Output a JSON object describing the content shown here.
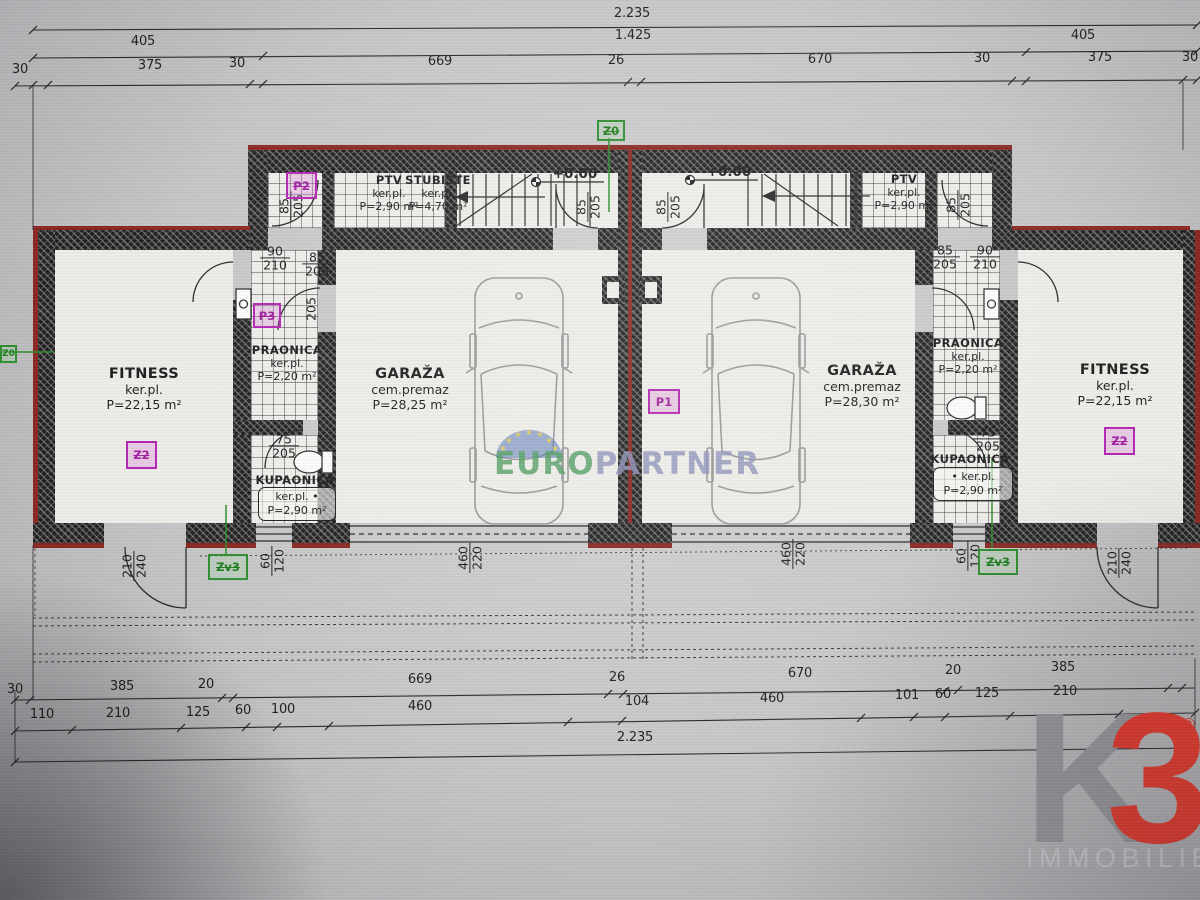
{
  "plan": {
    "dims_top": {
      "row1": [
        "2.235"
      ],
      "row2": [
        "405",
        "1.425",
        "405"
      ],
      "row3": [
        "30",
        "375",
        "30",
        "669",
        "26",
        "670",
        "30",
        "375",
        "30"
      ]
    },
    "dims_bottom": {
      "row1": [
        "30",
        "385",
        "20",
        "669",
        "26",
        "670",
        "20",
        "385"
      ],
      "row2": [
        "110",
        "210",
        "125",
        "60",
        "100",
        "460",
        "104",
        "460",
        "101",
        "60",
        "125",
        "210"
      ],
      "row3": [
        "2.235"
      ]
    },
    "levels": {
      "left": "+0.00",
      "right": "+0.00"
    },
    "rooms": {
      "fitness_left": {
        "name": "FITNESS",
        "finish": "ker.pl.",
        "area": "P=22,15 m²"
      },
      "fitness_right": {
        "name": "FITNESS",
        "finish": "ker.pl.",
        "area": "P=22,15 m²"
      },
      "garage_left": {
        "name": "GARAŽA",
        "finish": "cem.premaz",
        "area": "P=28,25 m²"
      },
      "garage_right": {
        "name": "GARAŽA",
        "finish": "cem.premaz",
        "area": "P=28,30 m²"
      },
      "ptv_left": {
        "name": "PTV",
        "finish": "ker.pl.",
        "area": "P=2,90 m²"
      },
      "ptv_right": {
        "name": "PTV",
        "finish": "ker.pl.",
        "area": "P=2,90 m²"
      },
      "stubiste": {
        "name": "STUBIŠTE",
        "finish": "ker.pl.",
        "area": "P=4,70 m²"
      },
      "praonica_left": {
        "name": "PRAONICA",
        "finish": "ker.pl.",
        "area": "P=2,20 m²"
      },
      "praonica_right": {
        "name": "PRAONICA",
        "finish": "ker.pl.",
        "area": "P=2,20 m²"
      },
      "kupaonica_left": {
        "name": "KUPAONICA",
        "finish": "ker.pl. •",
        "area": "P=2,90 m²"
      },
      "kupaonica_right": {
        "name": "KUPAONICA",
        "finish": "• ker.pl.",
        "area": "P=2,90 m²"
      }
    },
    "door_dims": {
      "entry_top_left": {
        "w": "85",
        "h": "205"
      },
      "entry_top_right": {
        "w": "85",
        "h": "205"
      },
      "mid_door_left": {
        "w": "85",
        "h": "205"
      },
      "mid_door_right": {
        "w": "85",
        "h": "205"
      },
      "hall_left_outer": {
        "w": "90",
        "h": "210"
      },
      "hall_left_inner": {
        "w": "85",
        "h": "205"
      },
      "hall_right_inner": {
        "w": "85",
        "h": "205"
      },
      "hall_right_outer": {
        "w": "90",
        "h": "210"
      },
      "bath_left": {
        "w": "75",
        "h": "205"
      },
      "bath_right": {
        "w": "75",
        "h": "205"
      },
      "laundry_left_h": "205",
      "entry_bottom_left": {
        "w": "210",
        "h": "240"
      },
      "entry_bottom_right": {
        "w": "210",
        "h": "240"
      },
      "window_left": {
        "w": "60",
        "h": "120"
      },
      "window_right": {
        "w": "60",
        "h": "120"
      },
      "garage_gate_left": {
        "w": "460",
        "h": "220"
      },
      "garage_gate_right": {
        "w": "460",
        "h": "220"
      }
    },
    "markers": {
      "z0": "Z0",
      "edge_left": "Z0",
      "p1": "P1",
      "p2": "P2",
      "p3": "P3",
      "z2_left": "Z2",
      "z2_right": "Z2",
      "zv3_left": "Zv3",
      "zv3_right": "Zv3"
    }
  },
  "watermark": {
    "euro": "EURO",
    "partner": "PARTNER"
  },
  "brand": {
    "k": "K",
    "three": "3",
    "reg": "®",
    "name": "IMMOBILIEN"
  },
  "colors": {
    "wall": "#1f1f1f",
    "accent_red": "#8c2823",
    "marker_magenta": "#b427b4",
    "marker_green": "#2f8f2f",
    "logo_red": "#e6372a",
    "logo_gray": "#98989c"
  }
}
